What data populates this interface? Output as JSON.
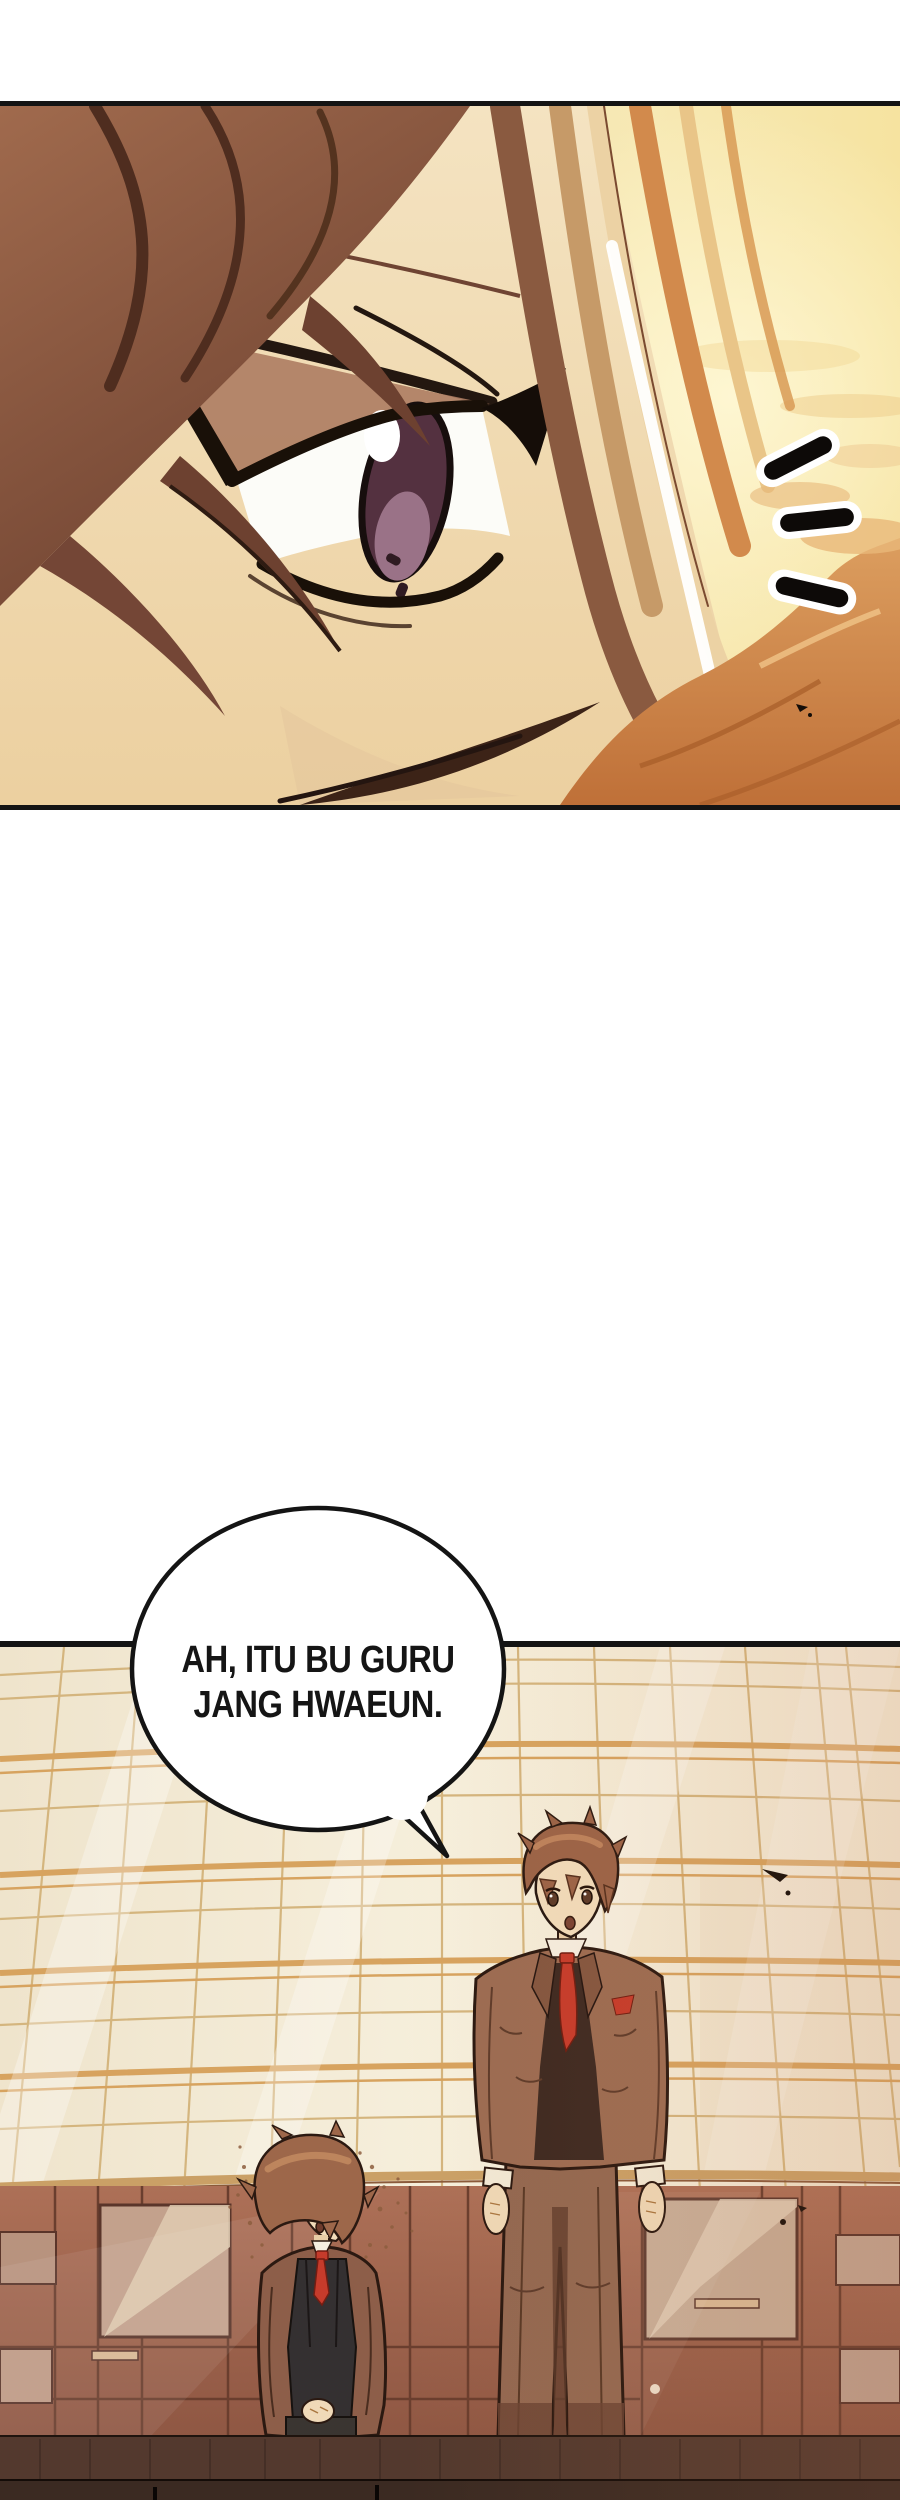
{
  "speech_bubble": {
    "lines": [
      "AH, ITU BU GURU",
      "JANG HWAEUN."
    ]
  },
  "emphasis_marks": {
    "count": 3
  },
  "panels": {
    "count": 2
  },
  "palette": {
    "paper": "#ffffff",
    "ink": "#141414",
    "sky-warm": "#f3e2b4",
    "sky-gold": "#f8ecc0",
    "cloud-orange": "#c97f43",
    "skin": "#f2e0bf",
    "hair-dark": "#8a5843",
    "hair-light": "#ecd2a4",
    "hair-orange": "#d28a4c",
    "iris": "#543140",
    "glass": "#f4eddb",
    "grid-line": "#d4b57e",
    "grid-band": "#d7a35f",
    "wall": "#a3654e",
    "wall-seam": "#6a3e2e",
    "door-pane": "#c3a18c",
    "floor": "#53392e",
    "floor-dark": "#3b2a22",
    "suit": "#9c6c52",
    "trousers": "#936851",
    "girl-blazer": "#8d5e49",
    "girl-vest": "#343031",
    "tie-red": "#c63b2b",
    "char-skin": "#f1dcba",
    "char-hair": "#9d674a",
    "bubble-fill": "#ffffff"
  }
}
